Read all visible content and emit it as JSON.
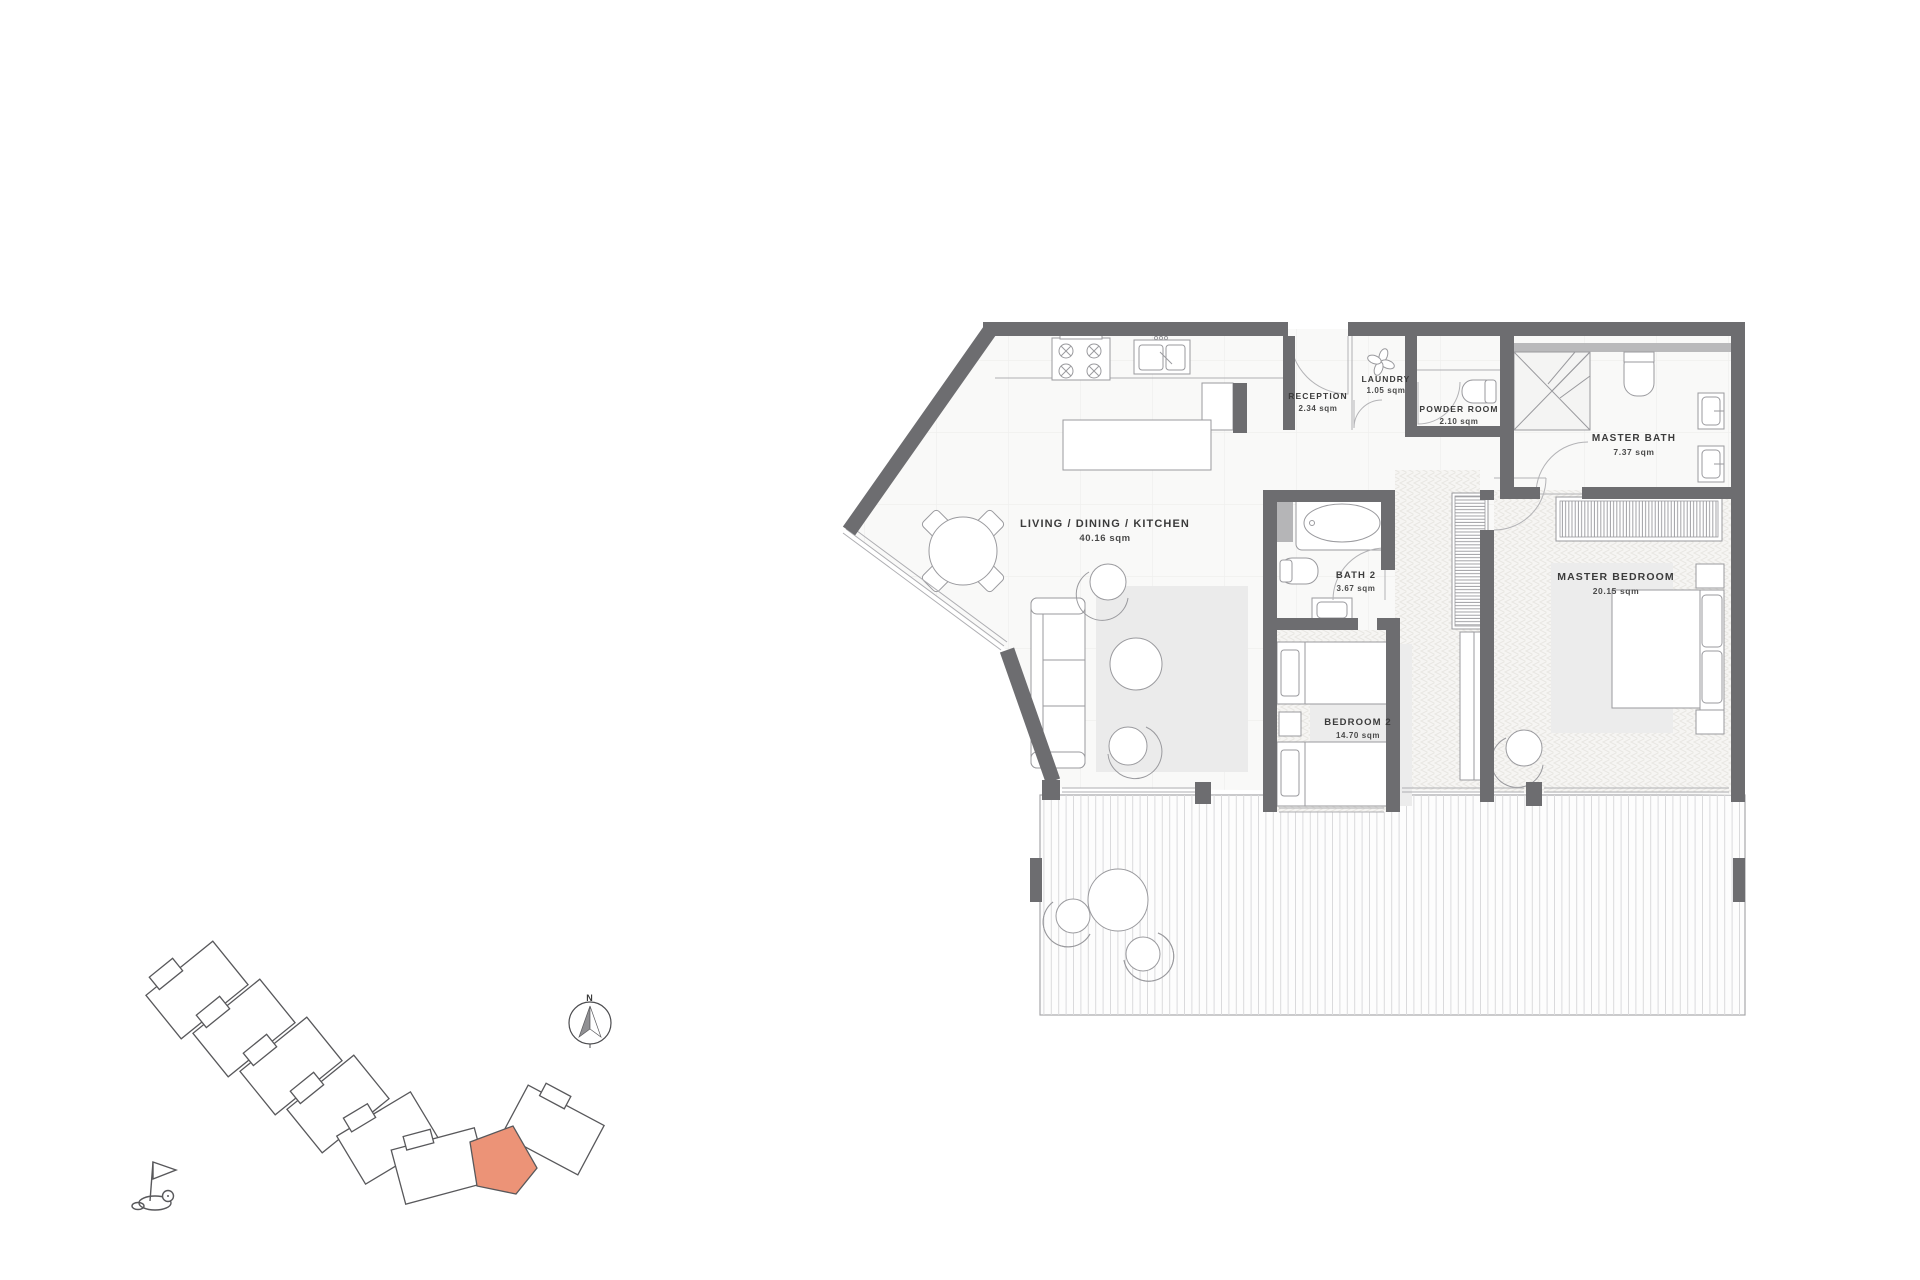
{
  "floor_plan": {
    "rooms": [
      {
        "name": "LIVING / DINING / KITCHEN",
        "area": "40.16 sqm"
      },
      {
        "name": "RECEPTION",
        "area": "2.34 sqm"
      },
      {
        "name": "LAUNDRY",
        "area": "1.05 sqm"
      },
      {
        "name": "POWDER ROOM",
        "area": "2.10 sqm"
      },
      {
        "name": "MASTER BATH",
        "area": "7.37 sqm"
      },
      {
        "name": "BATH 2",
        "area": "3.67 sqm"
      },
      {
        "name": "MASTER BEDROOM",
        "area": "20.15 sqm"
      },
      {
        "name": "BEDROOM 2",
        "area": "14.70 sqm"
      }
    ],
    "compass": {
      "label": "N"
    },
    "colors": {
      "wall": "#6d6d70",
      "highlighted_unit": "#ec9377",
      "drawing_line": "#9a9a9e"
    }
  }
}
